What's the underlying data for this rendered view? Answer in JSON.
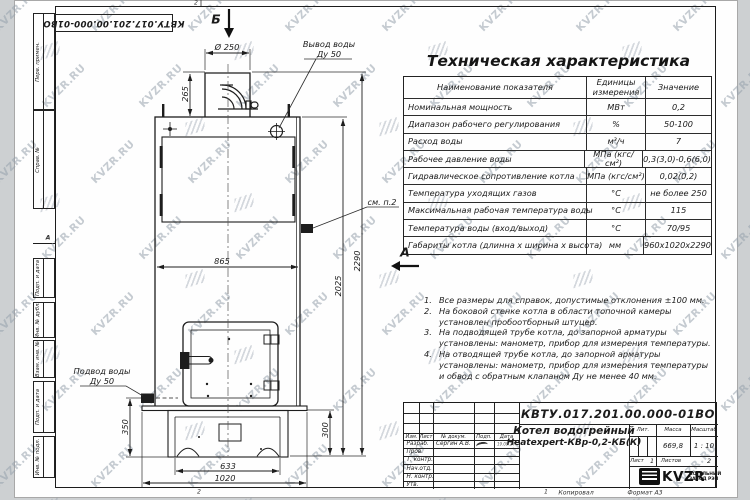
{
  "page": {
    "top_zone": "2",
    "bottom_zone_left": "2",
    "bottom_zone_mid": "1",
    "left_zone": "А",
    "copied": "Копировал",
    "format": "Формат А3"
  },
  "watermark": {
    "text": "KVZR.RU"
  },
  "stamp_top": {
    "doc_number": "КВТУ.017.201.00.000-01ВО"
  },
  "frame_fields": [
    "Перв. примен.",
    "Справ. №",
    "Подп. и дата",
    "Инв. № дубл.",
    "Взам. инв. №",
    "Подп. и дата",
    "Инв. № подл."
  ],
  "spec": {
    "title": "Техническая характеристика",
    "headers": [
      "Наименование показателя",
      "Единицы измерения",
      "Значение"
    ],
    "rows": [
      [
        "Номинальная мощность",
        "МВт",
        "0,2"
      ],
      [
        "Диапазон рабочего регулирования",
        "%",
        "50-100"
      ],
      [
        "Расход воды",
        "м³/ч",
        "7"
      ],
      [
        "Рабочее давление воды",
        "МПа (кгс/см²)",
        "0,3(3,0)-0,6(6,0)"
      ],
      [
        "Гидравлическое сопротивление котла",
        "МПа (кгс/см²)",
        "0,02(0,2)"
      ],
      [
        "Температура уходящих газов",
        "°С",
        "не более 250"
      ],
      [
        "Максимальная рабочая температура воды",
        "°С",
        "115"
      ],
      [
        "Температура воды (вход/выход)",
        "°С",
        "70/95"
      ],
      [
        "Габариты котла (длинна х ширина х высота)",
        "мм",
        "960х1020х2290"
      ]
    ]
  },
  "notes": [
    "Все размеры для справок, допустимые отклонения ±100 мм.",
    "На боковой стенке котла в области топочной камеры установлен пробоотборный штуцер.",
    "На подводящей трубе котла, до запорной арматуры установлены: манометр, прибор для измерения температуры.",
    "На отводящей трубе котла, до запорной арматуры установлены: манометр, прибор для измерения температуры и обвод с обратным клапаном Ду не менее 40 мм."
  ],
  "drawing": {
    "view_top": "Б",
    "view_side": "А",
    "see_note": "см. п.2",
    "outlet_l1": "Вывод воды",
    "outlet_l2": "Ду 50",
    "inlet_l1": "Подвод воды",
    "inlet_l2": "Ду 50",
    "dims": {
      "d250": "Ø 250",
      "h265": "265",
      "w865": "865",
      "h2025": "2025",
      "h2290": "2290",
      "h350": "350",
      "h300": "300",
      "w633": "633",
      "w1020": "1020"
    }
  },
  "title_block": {
    "doc_number": "КВТУ.017.201.00.000-01ВО",
    "product_line1": "Котел водогрейный",
    "product_line2": "Heatexpert-КВр-0,2-КБ(К)",
    "cols": [
      "Изм.",
      "Лист",
      "№ докум.",
      "Подп.",
      "Дата"
    ],
    "rows": [
      {
        "role": "Разраб.",
        "name": "Сергин А.В.",
        "date": "19.09.24"
      },
      {
        "role": "Пров.",
        "name": "",
        "date": ""
      },
      {
        "role": "Т. контр.",
        "name": "",
        "date": ""
      },
      {
        "role": "Нач.отд.",
        "name": "",
        "date": ""
      },
      {
        "role": "Н. контр.",
        "name": "",
        "date": ""
      },
      {
        "role": "Утв.",
        "name": "",
        "date": ""
      }
    ],
    "lit_label": "Лит.",
    "mass_label": "Масса",
    "scale_label": "Масштаб",
    "mass": "669,8",
    "scale": "1 : 10",
    "sheet_label": "Лист",
    "sheet": "1",
    "sheets_label": "Листов",
    "sheets": "2",
    "brand": "KVZR",
    "brand_sub1": "КОТЕЛЬНЫЙ",
    "brand_sub2": "ЗАВОД РЭП"
  }
}
